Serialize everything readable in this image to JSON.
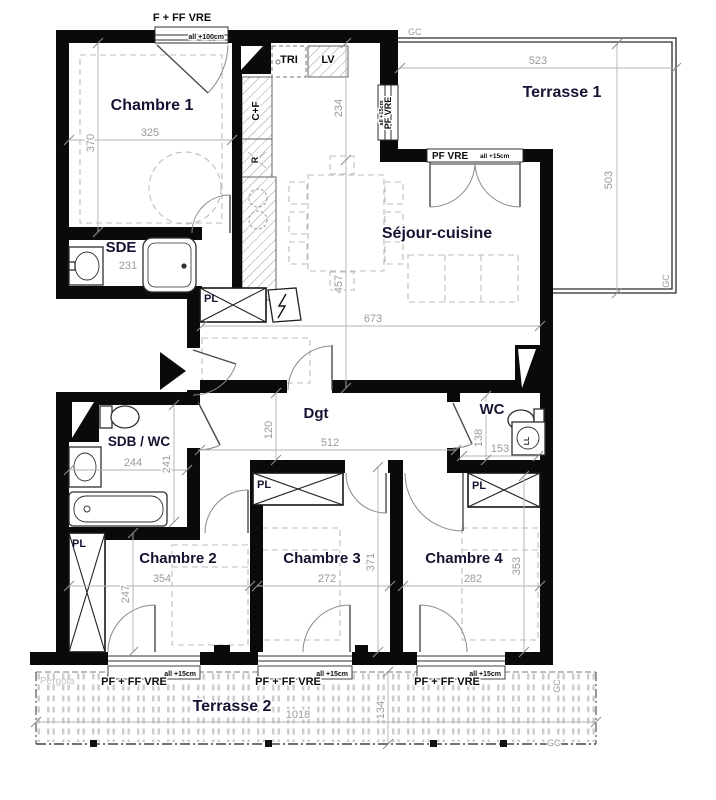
{
  "rooms": {
    "chambre1": {
      "name": "Chambre 1",
      "w": "325",
      "h": "370"
    },
    "sde": {
      "name": "SDE",
      "w": "231"
    },
    "sejour": {
      "name": "Séjour-cuisine",
      "w": "673",
      "h": "457",
      "entry": "234"
    },
    "terrasse1": {
      "name": "Terrasse 1",
      "w": "523",
      "h": "503"
    },
    "dgt": {
      "name": "Dgt",
      "w": "512",
      "h": "120"
    },
    "wc": {
      "name": "WC",
      "w": "153",
      "h": "138"
    },
    "sdb": {
      "name": "SDB / WC",
      "w": "244",
      "h": "241"
    },
    "chambre2": {
      "name": "Chambre 2",
      "w": "354",
      "h": "247"
    },
    "chambre3": {
      "name": "Chambre 3",
      "w": "272",
      "h": "371"
    },
    "chambre4": {
      "name": "Chambre 4",
      "w": "282",
      "h": "353"
    },
    "terrasse2": {
      "name": "Terrasse 2",
      "w": "1018",
      "h": "134"
    }
  },
  "windows": {
    "f_ff_vre": "F + FF VRE",
    "sill_100": "all +100cm",
    "pf_vre": "PF VRE",
    "sill_15": "all +15cm",
    "pf_ff_vre": "PF + FF VRE"
  },
  "labels": {
    "pl": "PL",
    "tri": "TRI",
    "lv": "LV",
    "cf": "C+F",
    "r": "R",
    "ll": "LL",
    "gc": "GC",
    "pergola": "Pergola"
  },
  "colors": {
    "wall": "#0a0a0a",
    "room_text": "#141432",
    "dim_text": "#9a9a9a",
    "hatch": "#9a9a9a"
  }
}
